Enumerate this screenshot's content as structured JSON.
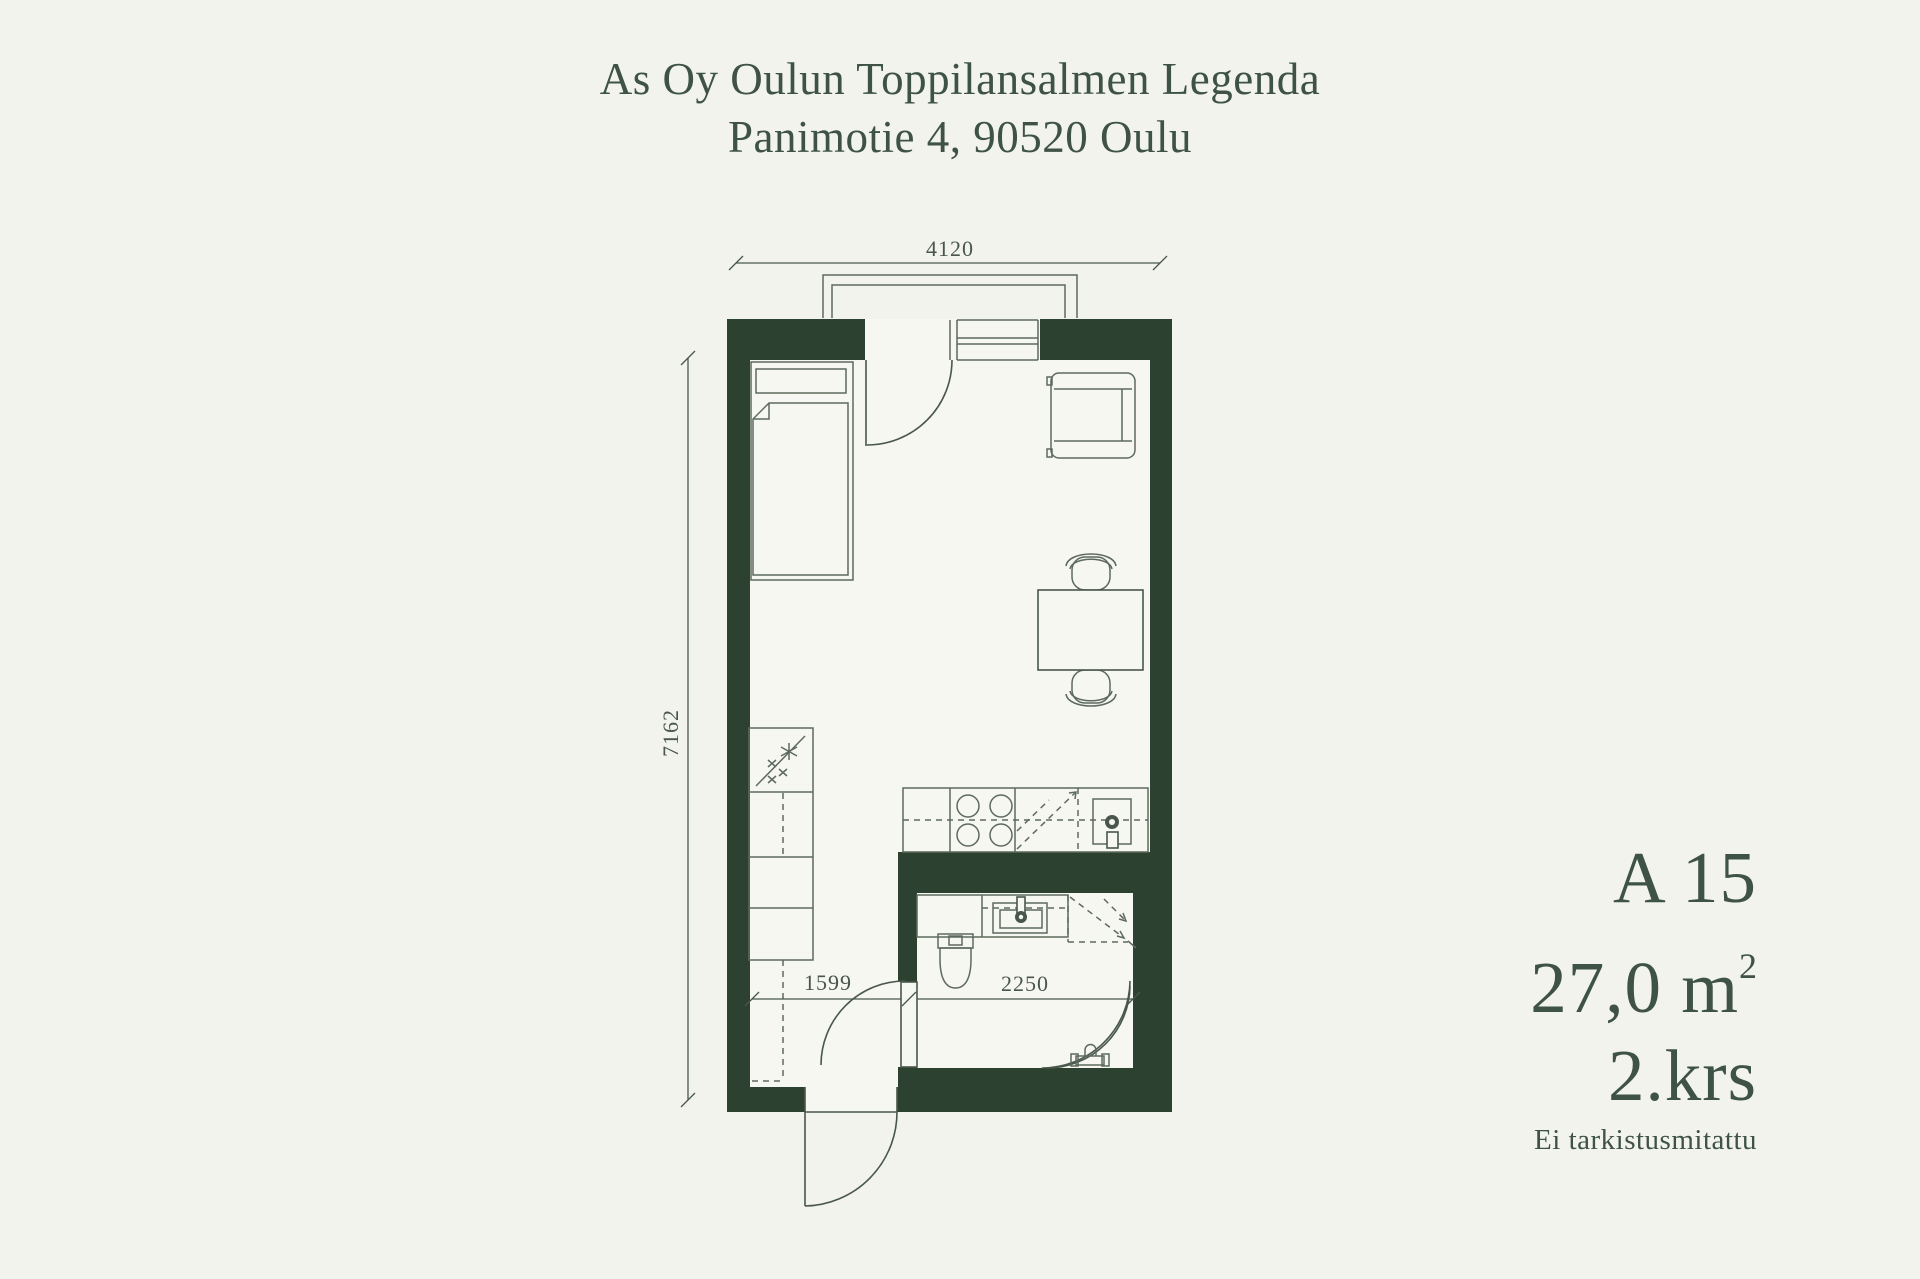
{
  "header": {
    "title_line1": "As Oy Oulun Toppilansalmen Legenda",
    "title_line2": "Panimotie 4, 90520 Oulu"
  },
  "apartment": {
    "code": "A 15",
    "area_value": "27,0 m",
    "area_superscript": "2",
    "floor": "2.krs",
    "note": "Ei tarkistusmitattu"
  },
  "dimensions": {
    "total_width_mm": "4120",
    "total_height_mm": "7162",
    "hall_width_mm": "1599",
    "bathroom_width_mm": "2250"
  },
  "colors": {
    "background": "#f2f3ec",
    "room": "#f6f7f0",
    "wall": "#2d4130",
    "line": "#49574a",
    "text": "#3e5345"
  }
}
